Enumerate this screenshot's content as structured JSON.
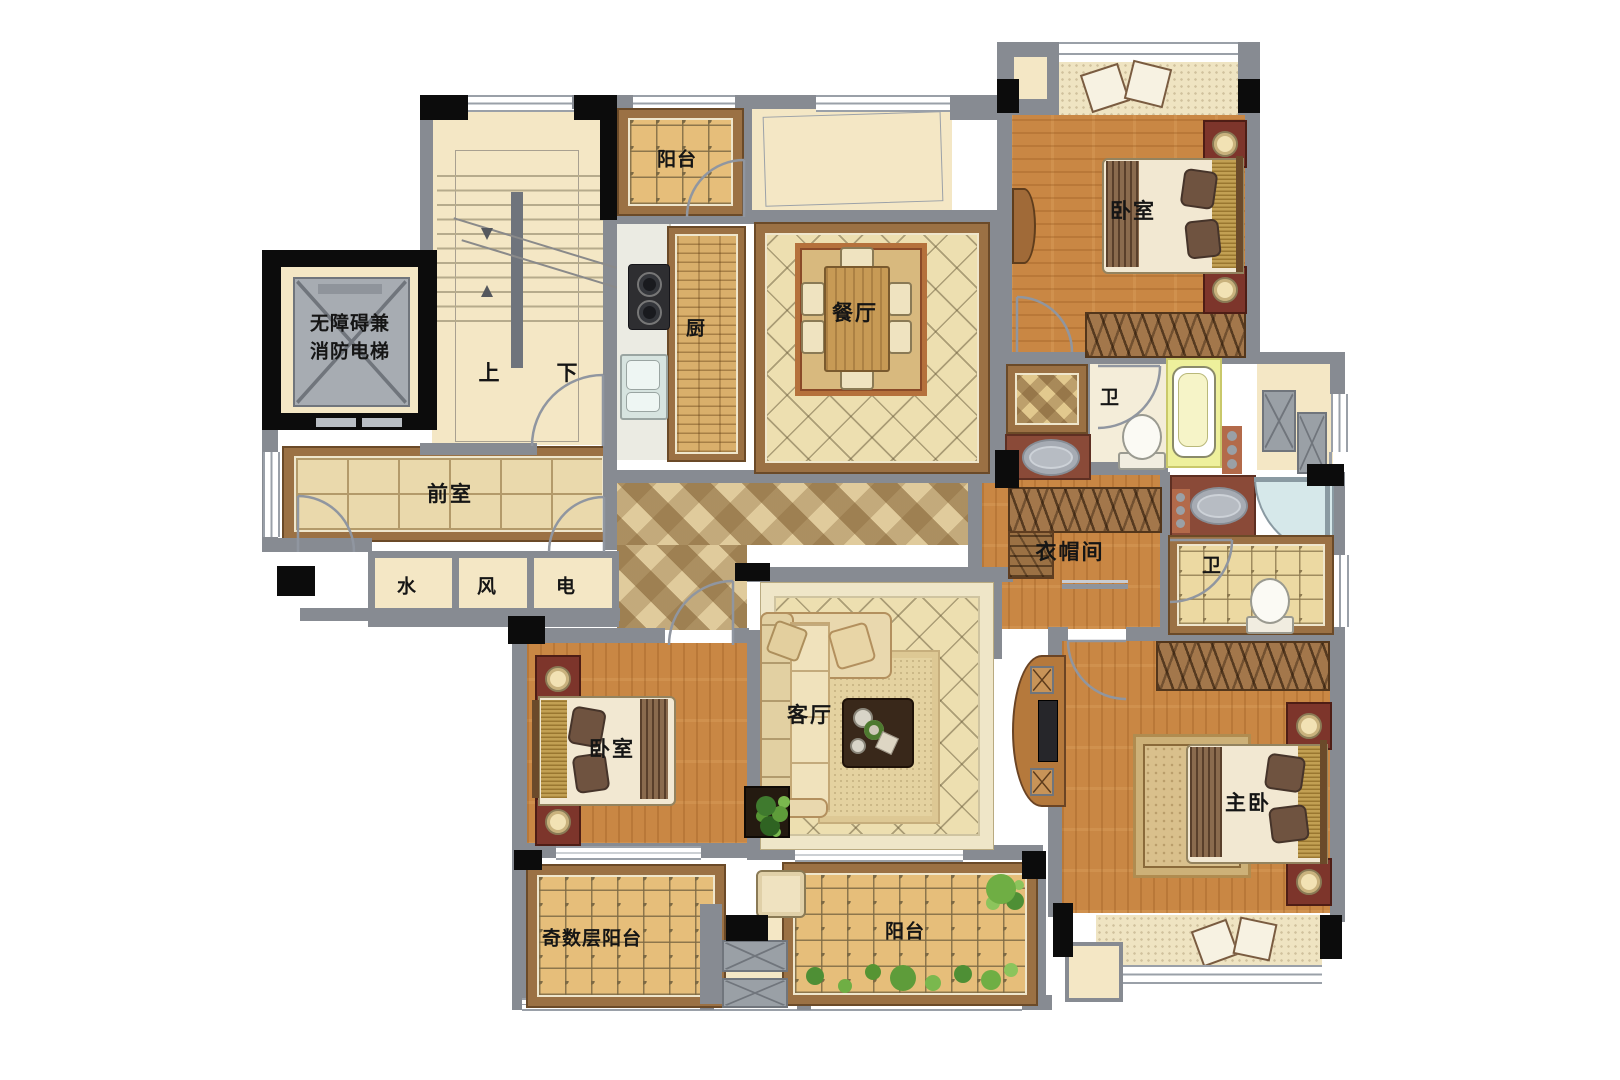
{
  "title": "四室两厅户型平面图",
  "palette": {
    "wall": "#878b92",
    "column": "#0c0c0c",
    "cream": "#f4e7c5",
    "wood_floor": "#c98744",
    "tile_floor": "#eddfb0",
    "balcony_tile": "#e6be7a",
    "trim_brown": "#9b7144",
    "nightstand_red": "#7d352b",
    "counter_red": "#8a4a38",
    "bathtub_yellow": "#eef09c",
    "shower_glass": "#d6e8ea",
    "plant_green": "#5e9c3a"
  },
  "rooms": {
    "balcony_top": {
      "label": "阳台"
    },
    "kitchen": {
      "label": "厨"
    },
    "dining": {
      "label": "餐厅"
    },
    "bedroom_top_right": {
      "label": "卧室"
    },
    "elevator": {
      "line1": "无障碍兼",
      "line2": "消防电梯"
    },
    "stairs": {
      "up": "上",
      "down": "下"
    },
    "vestibule": {
      "label": "前室"
    },
    "shaft_water": {
      "label": "水"
    },
    "shaft_air": {
      "label": "风"
    },
    "shaft_power": {
      "label": "电"
    },
    "bath_upper": {
      "label": "卫"
    },
    "closet": {
      "label": "衣帽间"
    },
    "bath_lower": {
      "label": "卫"
    },
    "living": {
      "label": "客厅"
    },
    "bedroom_left": {
      "label": "卧室"
    },
    "master_bedroom": {
      "label": "主卧"
    },
    "balcony_odd": {
      "label": "奇数层阳台"
    },
    "balcony_bottom": {
      "label": "阳台"
    }
  }
}
